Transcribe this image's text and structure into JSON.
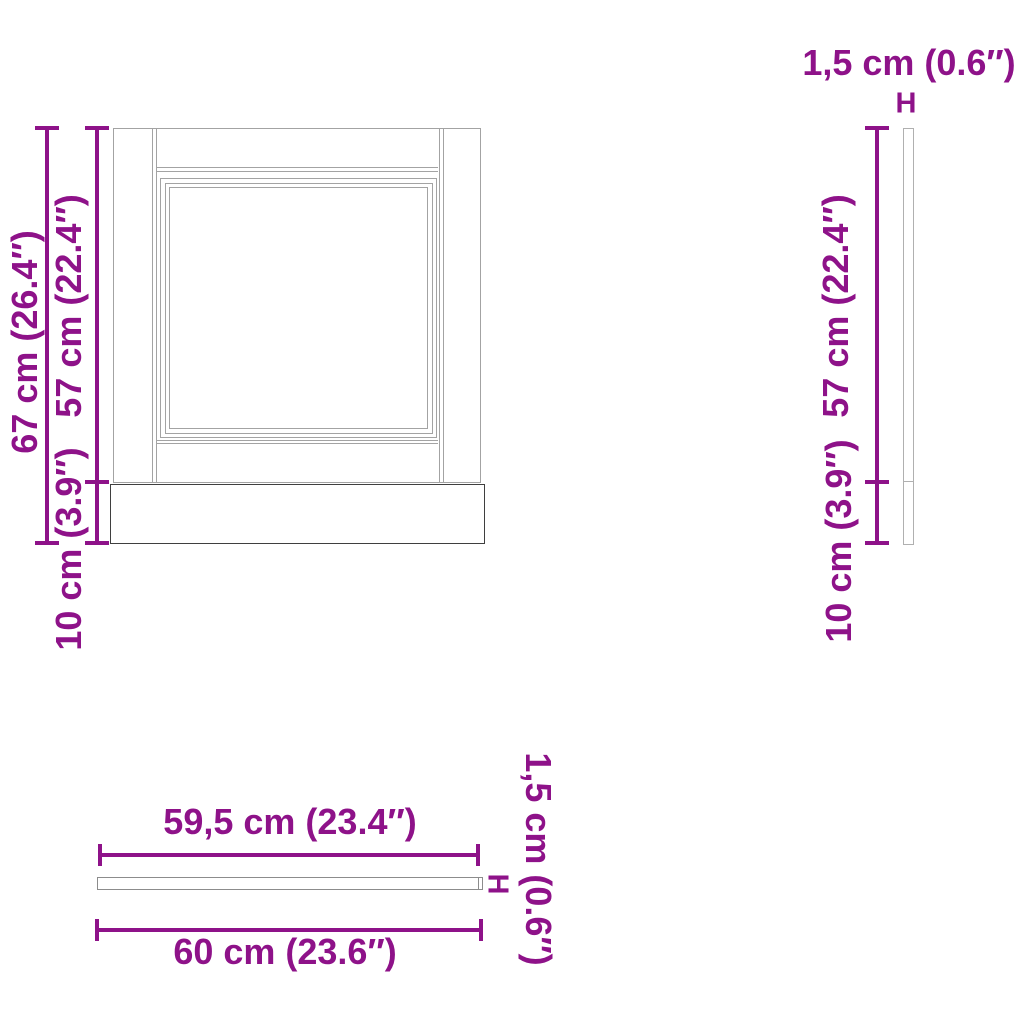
{
  "diagram": {
    "front_view": {
      "total_height": "67 cm (26.4″)",
      "door_height": "57 cm (22.4″)",
      "plinth_height": "10 cm (3.9″)"
    },
    "side_view": {
      "thickness": "1,5 cm (0.6″)",
      "thickness_marker": "H",
      "door_height": "57 cm (22.4″)",
      "plinth_height": "10 cm (3.9″)"
    },
    "top_view": {
      "panel_width": "59,5 cm (23.4″)",
      "total_width": "60 cm (23.6″)",
      "thickness": "1,5 cm (0.6″)",
      "thickness_marker": "H"
    },
    "colors": {
      "dimension_purple": "#8e1289",
      "drawing_light_gray": "#a3a3a3",
      "drawing_dark_gray": "#3f3f3f"
    }
  }
}
